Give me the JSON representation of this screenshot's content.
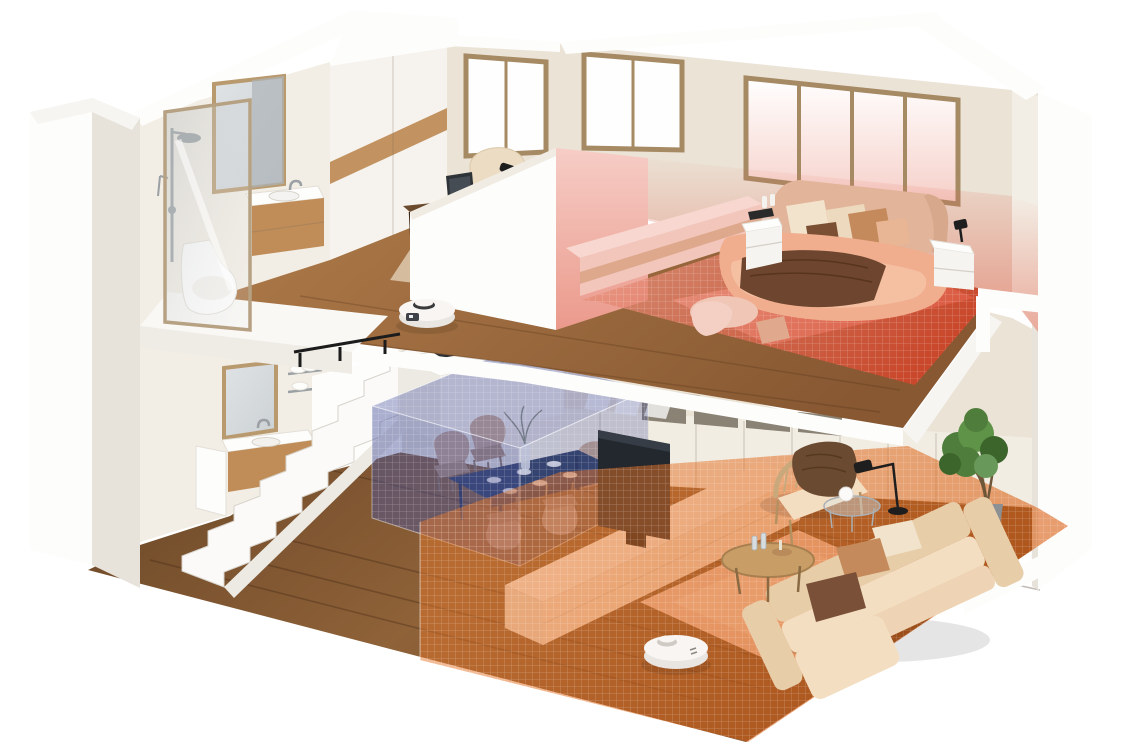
{
  "palette": {
    "bg": "#ffffff",
    "wallCream": "#ebe3d6",
    "wallCreamLight": "#f3eee5",
    "wallWhite": "#fafaf8",
    "wallShadow": "#ddd6c9",
    "cutWhite": "#fdfdfc",
    "cutEdge": "#e7e3db",
    "woodUpperA": "#b07c4a",
    "woodUpperB": "#875832",
    "woodLowerA": "#8f6238",
    "woodLowerB": "#684527",
    "woodCabinet": "#c08d58",
    "woodStripe": "#c29260",
    "walnutTop": "#6b4a2e",
    "walnutDark": "#4e341f",
    "frameTan": "#a68a64",
    "windowGlass": "#fefefe",
    "mirrorGlass": "#ccd1d4",
    "chrome": "#9aa0a4",
    "porcelain": "#fdfdfc",
    "zoneRedA": "#e89a86",
    "zoneRedB": "#d5452a",
    "zoneRedWall": "#e06a55",
    "zoneBlue": "#4a55a0",
    "zoneOrangeA": "#e97b2e",
    "zoneOrangeB": "#d95f14",
    "rugBedroom": "#f2b8a8",
    "rugLiving": "#edcab6",
    "rugLivingInner": "#f4dac8",
    "rugOffice": "#dcc4a8",
    "bedDuvet": "#f0ae8e",
    "bedDuvetLight": "#f6c4a8",
    "headboard": "#e2b49a",
    "pillowCream": "#f2e3cc",
    "pillowTan": "#c58a5c",
    "pillowBrown": "#7a4f33",
    "throwBrown": "#6e4630",
    "pouf": "#f0c6b6",
    "benchPink": "#f7d7cf",
    "benchPinkFront": "#f3c6bc",
    "benchStripe": "#dda88c",
    "navyTable": "#2d3c5e",
    "navyDark": "#232f4c",
    "chairBeige": "#c9a98f",
    "chairBeigeDark": "#b28e74",
    "tvPanel": "#23272e",
    "tvSheen": "#3c434c",
    "consoleTop": "#f8efe4",
    "consoleFront": "#f4e2d0",
    "sofaCream": "#f3dec2",
    "sofaShade": "#e8cda9",
    "sofaFront": "#eed4b4",
    "woodArm": "#c9a87c",
    "lampBlack": "#1e1e1e",
    "plantGreen": "#4f7d3b",
    "plantGreenDark": "#3c652c",
    "plantGreenLight": "#69995a",
    "potGray": "#8d9093",
    "trunkBrown": "#6e5639",
    "robotBody": "#f8f5f3",
    "robotSide": "#e9e5e1",
    "robotDark": "#3e4248"
  },
  "scene": {
    "type": "3d-cutaway-smart-home-render",
    "floors": [
      {
        "name": "upper-floor",
        "rooms": [
          "bathroom",
          "wardrobe-hallway",
          "home-office",
          "bedroom"
        ]
      },
      {
        "name": "lower-floor",
        "rooms": [
          "guest-bathroom",
          "staircase",
          "kitchen",
          "dining-area",
          "living-room"
        ]
      }
    ],
    "cleaning_zones": [
      {
        "room": "bedroom",
        "shape": "floor-and-walls-wash",
        "color": "#d5452a",
        "pattern": "grid"
      },
      {
        "room": "dining-area",
        "shape": "3d-box",
        "color": "#4a55a0",
        "pattern": "grid"
      },
      {
        "room": "living-room",
        "shape": "floor-polygon",
        "color": "#e97b2e",
        "pattern": "grid"
      }
    ],
    "robot_vacuums": [
      {
        "id": 1,
        "location": "upper-floor-hallway",
        "color": "#f8f5f3"
      },
      {
        "id": 2,
        "location": "living-room-near-rug",
        "color": "#f8f5f3"
      }
    ]
  }
}
